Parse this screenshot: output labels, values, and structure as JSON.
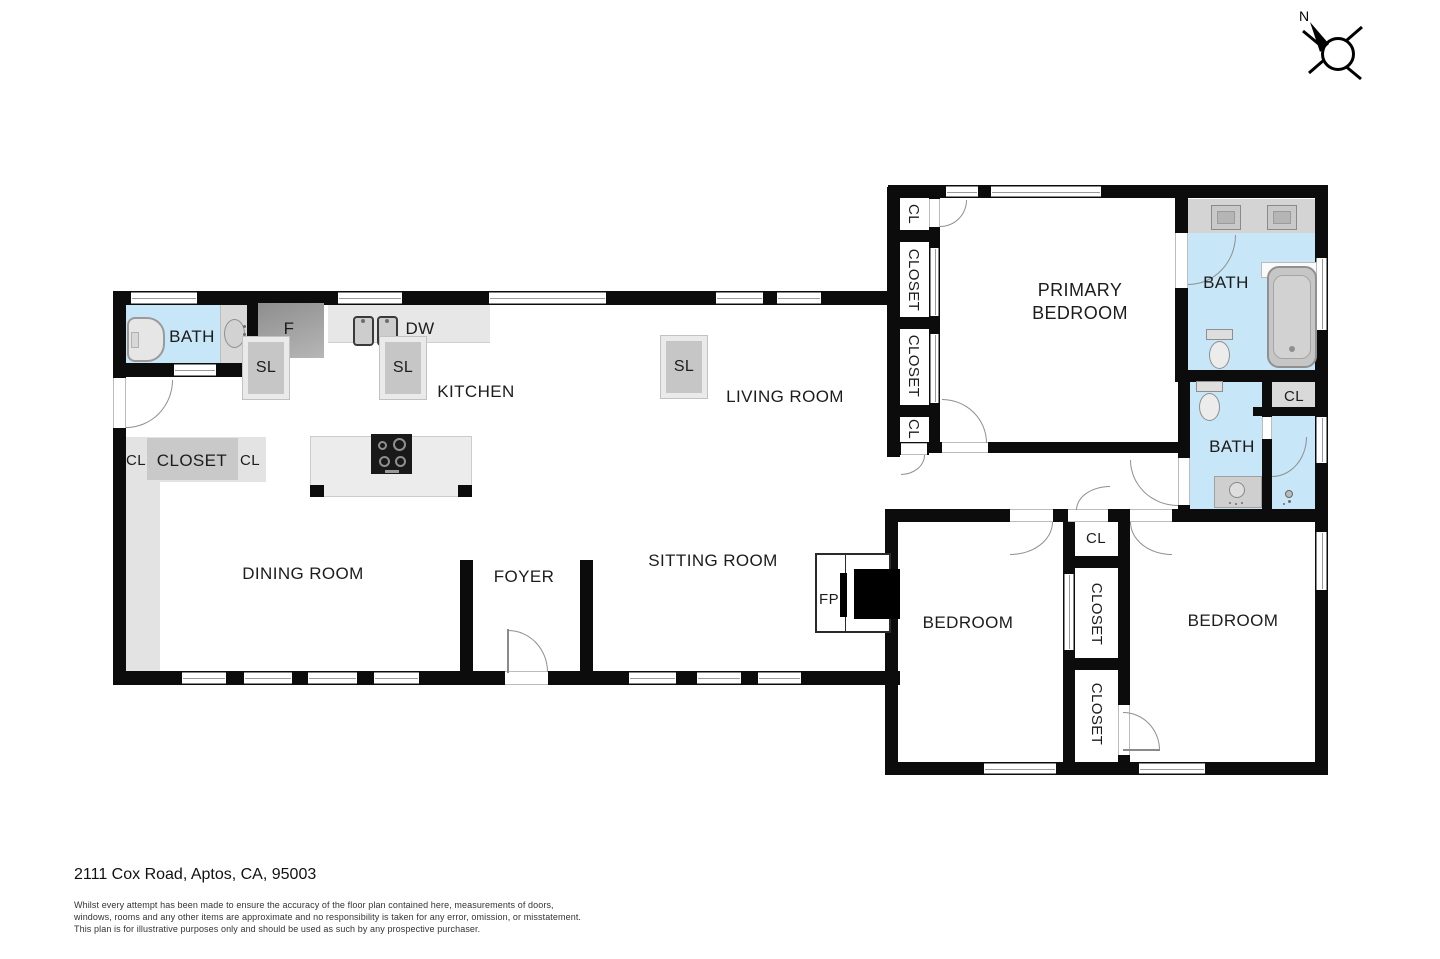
{
  "title_block": {
    "address": "2111 Cox Road, Aptos, CA, 95003",
    "disclaimer_line1": "Whilst every attempt has been made to ensure the accuracy of the floor plan contained here, measurements of doors,",
    "disclaimer_line2": "windows, rooms and any other items are approximate and no responsibility is taken for any error, omission, or misstatement.",
    "disclaimer_line3": "This plan is for illustrative purposes only and should be used as such by any prospective purchaser."
  },
  "compass": {
    "north_label": "N"
  },
  "rooms": {
    "bath_main": "BATH",
    "kitchen": "KITCHEN",
    "living_room": "LIVING ROOM",
    "dining_room": "DINING ROOM",
    "foyer": "FOYER",
    "sitting_room": "SITTING ROOM",
    "primary_bedroom": "PRIMARY BEDROOM",
    "primary_bath": "BATH",
    "hall_bath": "BATH",
    "bedroom_left": "BEDROOM",
    "bedroom_right": "BEDROOM"
  },
  "labels": {
    "closet": "CLOSET",
    "closet_abbr": "CL",
    "skylight": "SL",
    "fridge": "F",
    "dishwasher": "DW",
    "fireplace": "FP"
  },
  "colors": {
    "wall": "#0c0c0c",
    "bath_floor": "#c7e6f7",
    "counter_gray": "#e7e7e7",
    "closet_gray": "#c9c9c9"
  }
}
